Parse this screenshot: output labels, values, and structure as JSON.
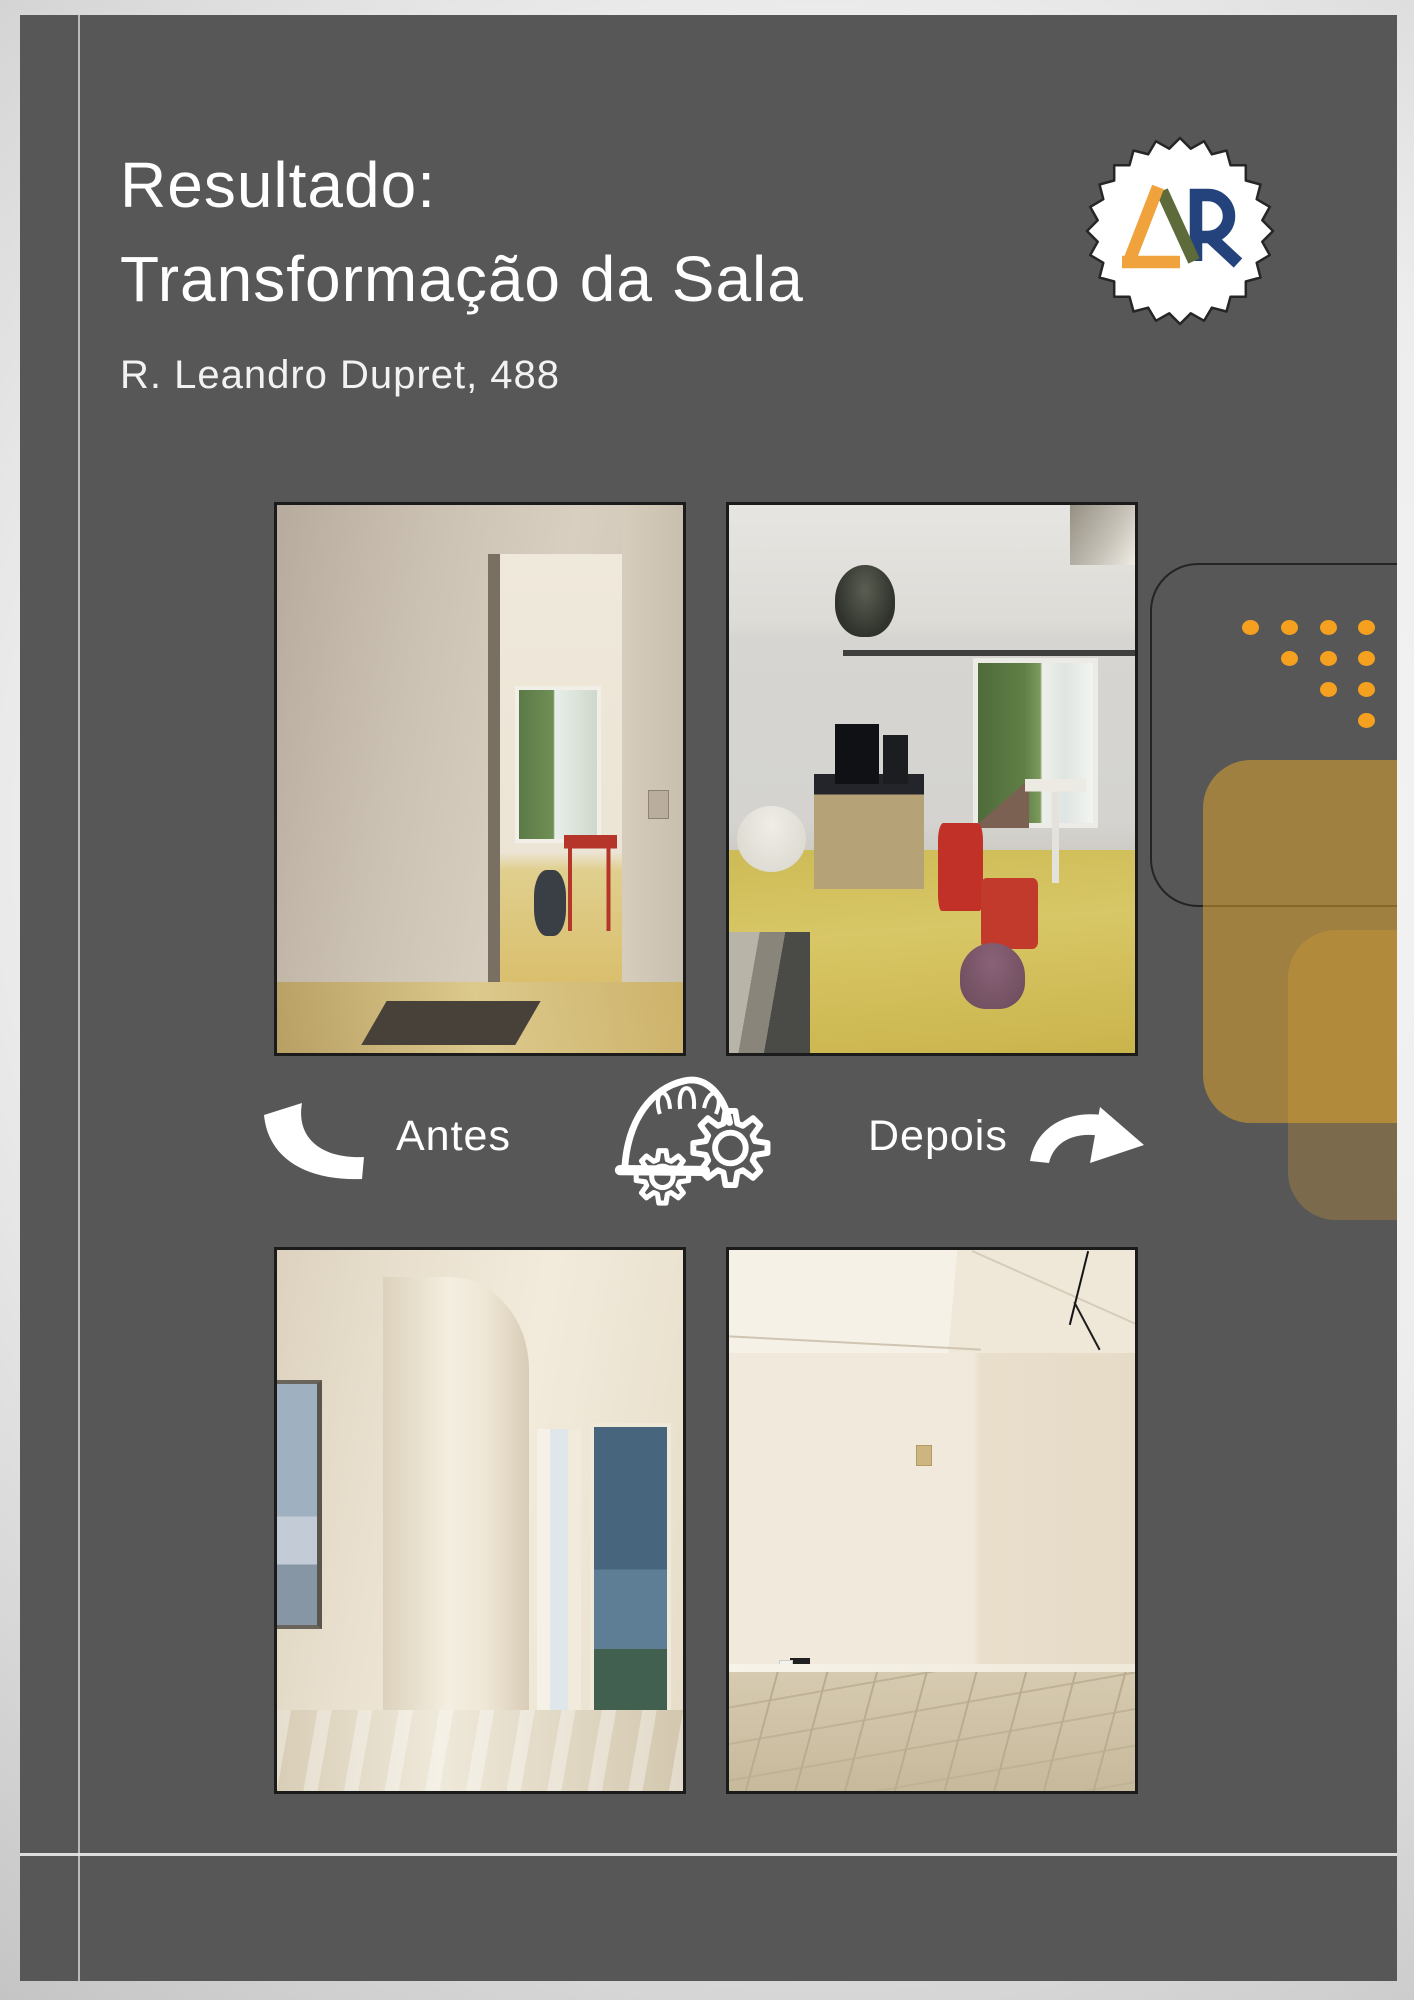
{
  "page": {
    "title_line1": "Resultado:",
    "title_line2": "Transformação da Sala",
    "subtitle": "R. Leandro Dupret, 488"
  },
  "badge": {
    "monogram": "LAR",
    "colors": {
      "letter_l": "#F0A23C",
      "letter_a": "#5C6B39",
      "letter_r": "#24427C"
    }
  },
  "divider": {
    "before_label": "Antes",
    "after_label": "Depois"
  },
  "photos": [
    {
      "id": "before-hallway",
      "alt": "corredor antes"
    },
    {
      "id": "before-room",
      "alt": "sala antes"
    },
    {
      "id": "after-hallway",
      "alt": "corredor depois"
    },
    {
      "id": "after-room",
      "alt": "sala depois"
    }
  ],
  "decor": {
    "card_color": "#575757",
    "accent_orange": "#F5A01F",
    "mustard_overlay": "#E4A62E",
    "line_color": "#ECECEC"
  }
}
